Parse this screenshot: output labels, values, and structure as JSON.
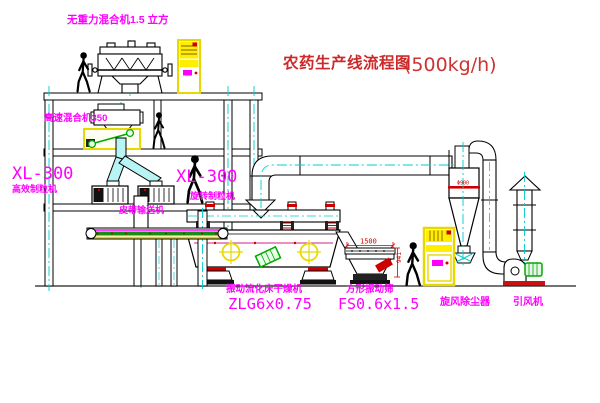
{
  "title": {
    "name": "农药生产线流程图",
    "capacity": "(500kg/h)"
  },
  "labels": {
    "gravity_free_mixer": "无重力混合机1.5 立方",
    "high_speed_mixer": "高速混合机350",
    "granulator_left_model": "XL-300",
    "granulator_left_type": "高效制粒机",
    "granulator_right_model": "XL-300",
    "granulator_right_type": "旋转制粒机",
    "belt_conveyor": "皮带输送机",
    "dryer_type": "振动流化床干燥机",
    "dryer_model": "ZLG6x0.75",
    "screen_type": "方形振动筛",
    "screen_model": "FS0.6x1.5",
    "cyclone": "旋风除尘器",
    "fan": "引风机"
  },
  "dimensions": {
    "screen_width": "1500",
    "screen_height": "941",
    "cyclone_dia": "Φ900"
  },
  "colors": {
    "label_magenta": "#ff00ff",
    "title_red": "#cc2a2a",
    "outline": "#000000",
    "centerline_cyan": "#00cccc",
    "cabinet_yellow": "#ffee00",
    "accent_red": "#cc0000",
    "accent_green": "#00aa00"
  }
}
